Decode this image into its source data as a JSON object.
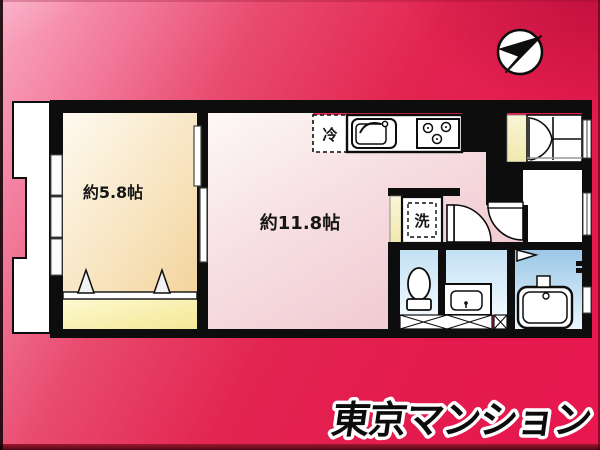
{
  "branding": {
    "logo_text": "東京マンション"
  },
  "floorplan": {
    "rooms": [
      {
        "name": "bedroom",
        "size_label": "約5.8帖"
      },
      {
        "name": "living-dining-kitchen",
        "size_label": "約11.8帖"
      }
    ],
    "fixture_labels": {
      "refrigerator": "冷",
      "washing_machine": "洗"
    }
  },
  "icons": {
    "compass": "north-arrow-icon"
  },
  "colors": {
    "background_red": "#e41b4e",
    "background_light_pink": "#f9a9c3",
    "wall_black": "#0d0d0d",
    "bedroom_floor": "#f3d49c",
    "closet_floor_yellow": "#f6ec9b",
    "living_floor_pink": "#eec3cb",
    "water_area_blue": "#a8cfe8",
    "logo_fill": "#0c0c0c",
    "logo_outline": "#ffffff"
  }
}
